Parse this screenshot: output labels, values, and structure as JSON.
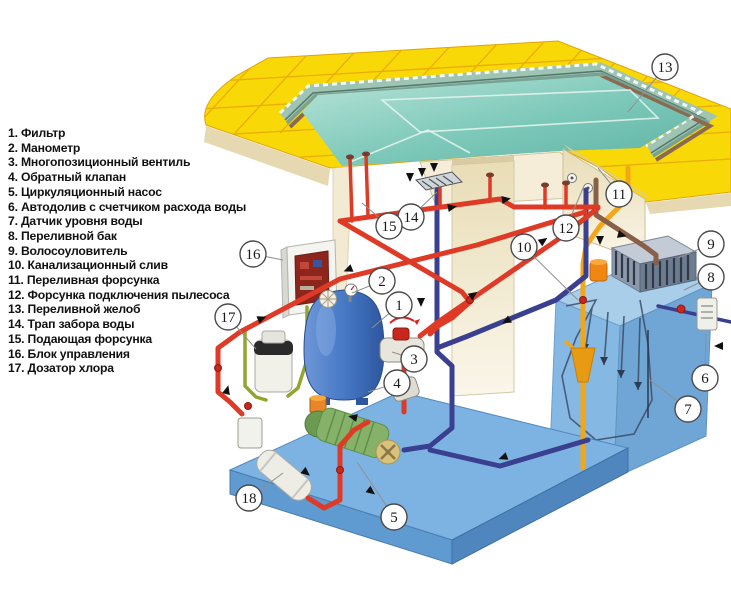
{
  "legend": {
    "items": [
      "1. Фильтр",
      "2. Манометр",
      "3. Многопозиционный вентиль",
      "4. Обратный клапан",
      "5. Циркуляционный насос",
      "6. Автодолив с счетчиком расхода воды",
      "7. Датчик уровня воды",
      "8. Переливной бак",
      "9. Волосоуловитель",
      "10. Канализационный слив",
      "11. Переливная форсунка",
      "12. Форсунка подключения пылесоса",
      "13. Переливной желоб",
      "14. Трап забора воды",
      "15. Подающая форсунка",
      "16. Блок управления",
      "17. Дозатор хлора"
    ]
  },
  "callouts": [
    "1",
    "2",
    "3",
    "4",
    "5",
    "6",
    "7",
    "8",
    "9",
    "10",
    "11",
    "12",
    "13",
    "14",
    "15",
    "16",
    "17",
    "18"
  ],
  "colors": {
    "supply_pipe": "#DF3A26",
    "return_pipe": "#3A3F90",
    "sewer_pipe": "#F2A71B",
    "gutter_pipe": "#8A5F48",
    "doser_pipe": "#93A42F",
    "pool_water": "#7CC8B9",
    "deck_tile": "#F8D806",
    "tile_grout": "#E9A50B",
    "overflow_tank": "#85B9E3",
    "filter_tank": "#4679C5",
    "equipment_pad": "#7DB3E2",
    "wall_beige": "#EFE6C8"
  }
}
